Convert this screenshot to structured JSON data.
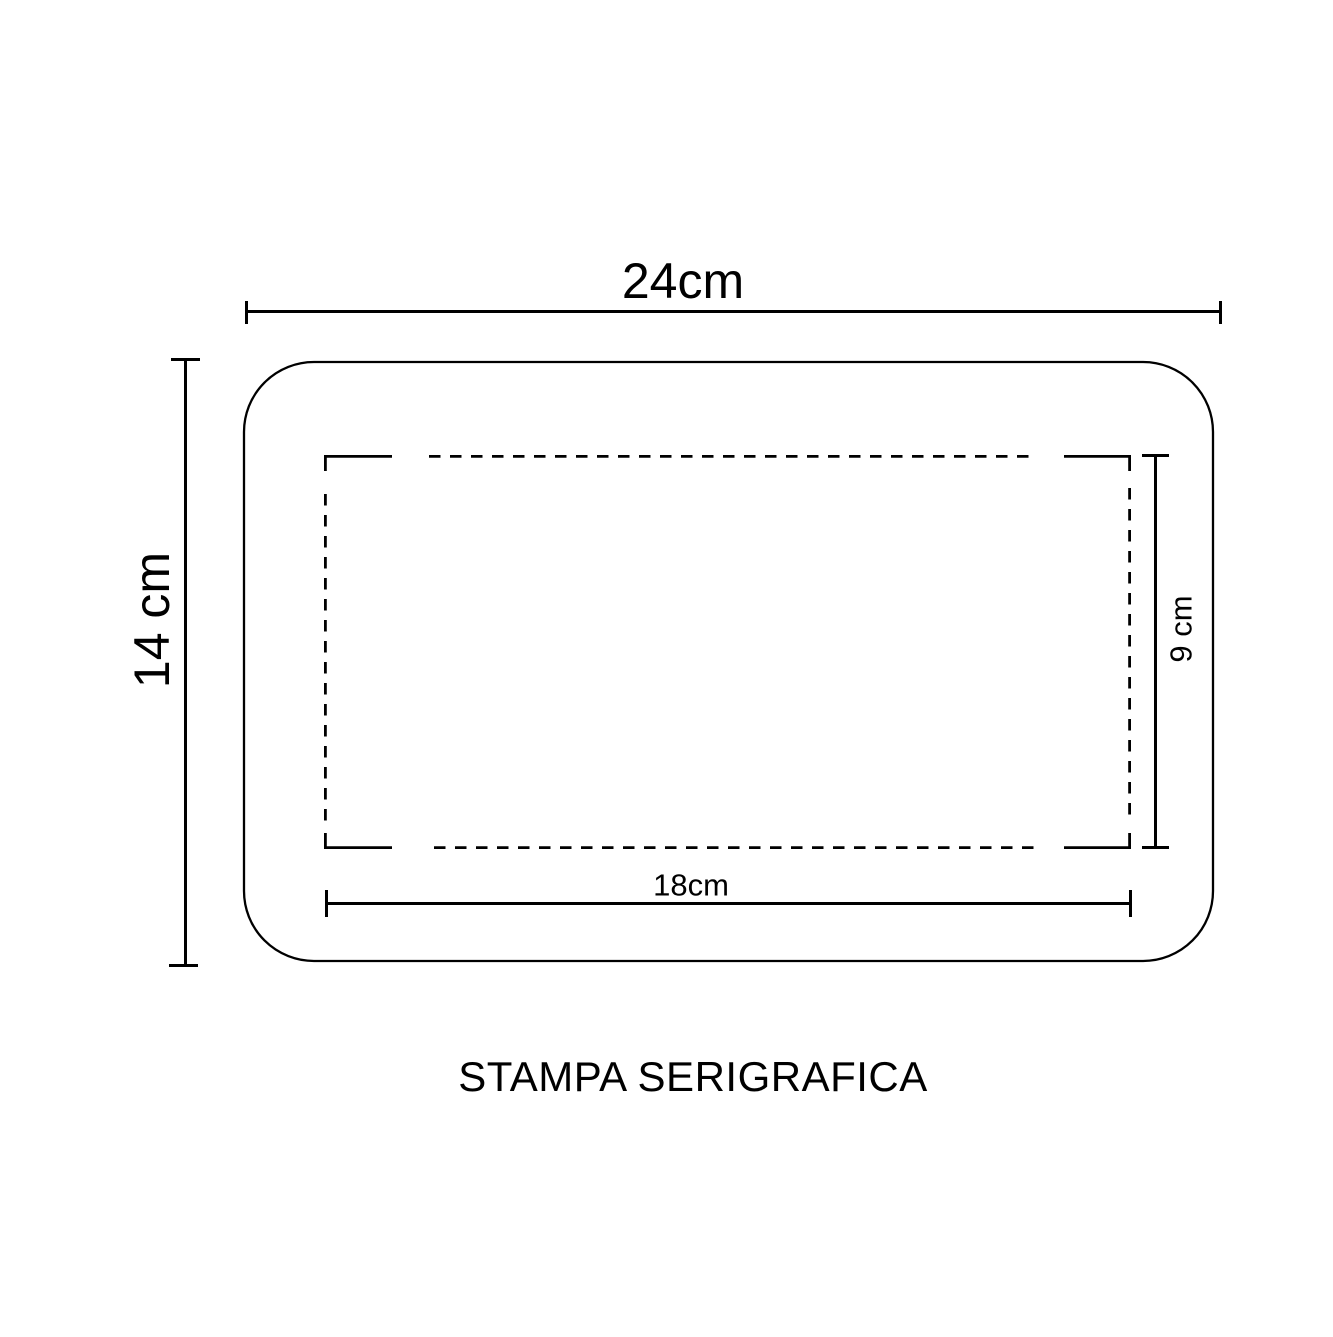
{
  "drawing": {
    "caption": "STAMPA SERIGRAFICA",
    "line_color": "#000000",
    "background_color": "#ffffff",
    "dimensions": {
      "outer_width_label": "24cm",
      "outer_height_label": "14 cm",
      "print_width_label": "18cm",
      "print_height_label": "9 cm"
    }
  }
}
